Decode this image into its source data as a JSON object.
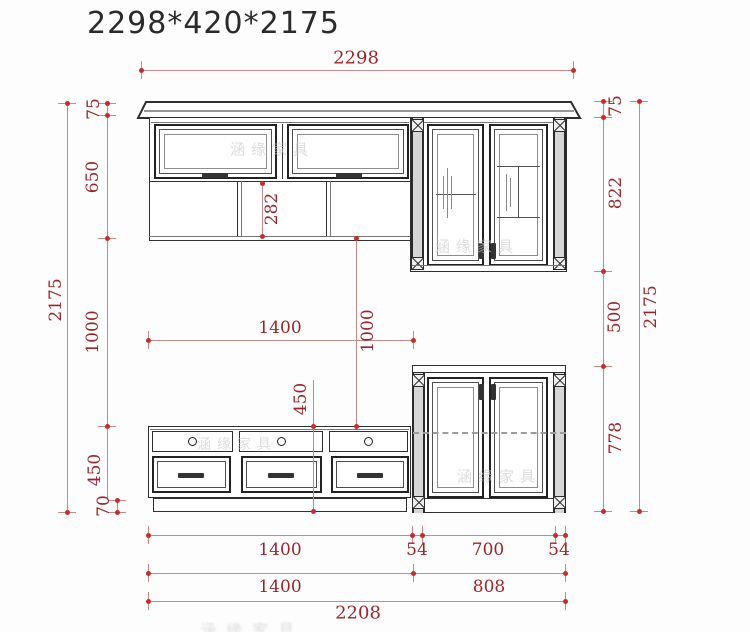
{
  "title": "2298*420*2175",
  "watermark": {
    "text": "涵缘家具"
  },
  "dims": {
    "top_width": "2298",
    "left_total": "2175",
    "left_crown": "75",
    "left_upper": "650",
    "left_gap": "1000",
    "left_stand": "450",
    "left_plinth": "70",
    "mid_shelf": "282",
    "mid_width": "1400",
    "mid_gap": "1000",
    "mid_stand": "450",
    "right_crown": "75",
    "right_upper": "822",
    "right_gap": "500",
    "right_lower": "778",
    "right_total": "2175",
    "b1_left": "1400",
    "b1_p1": "54",
    "b1_mid": "700",
    "b1_p2": "54",
    "b2_left": "1400",
    "b2_right": "808",
    "b3_total": "2208"
  }
}
